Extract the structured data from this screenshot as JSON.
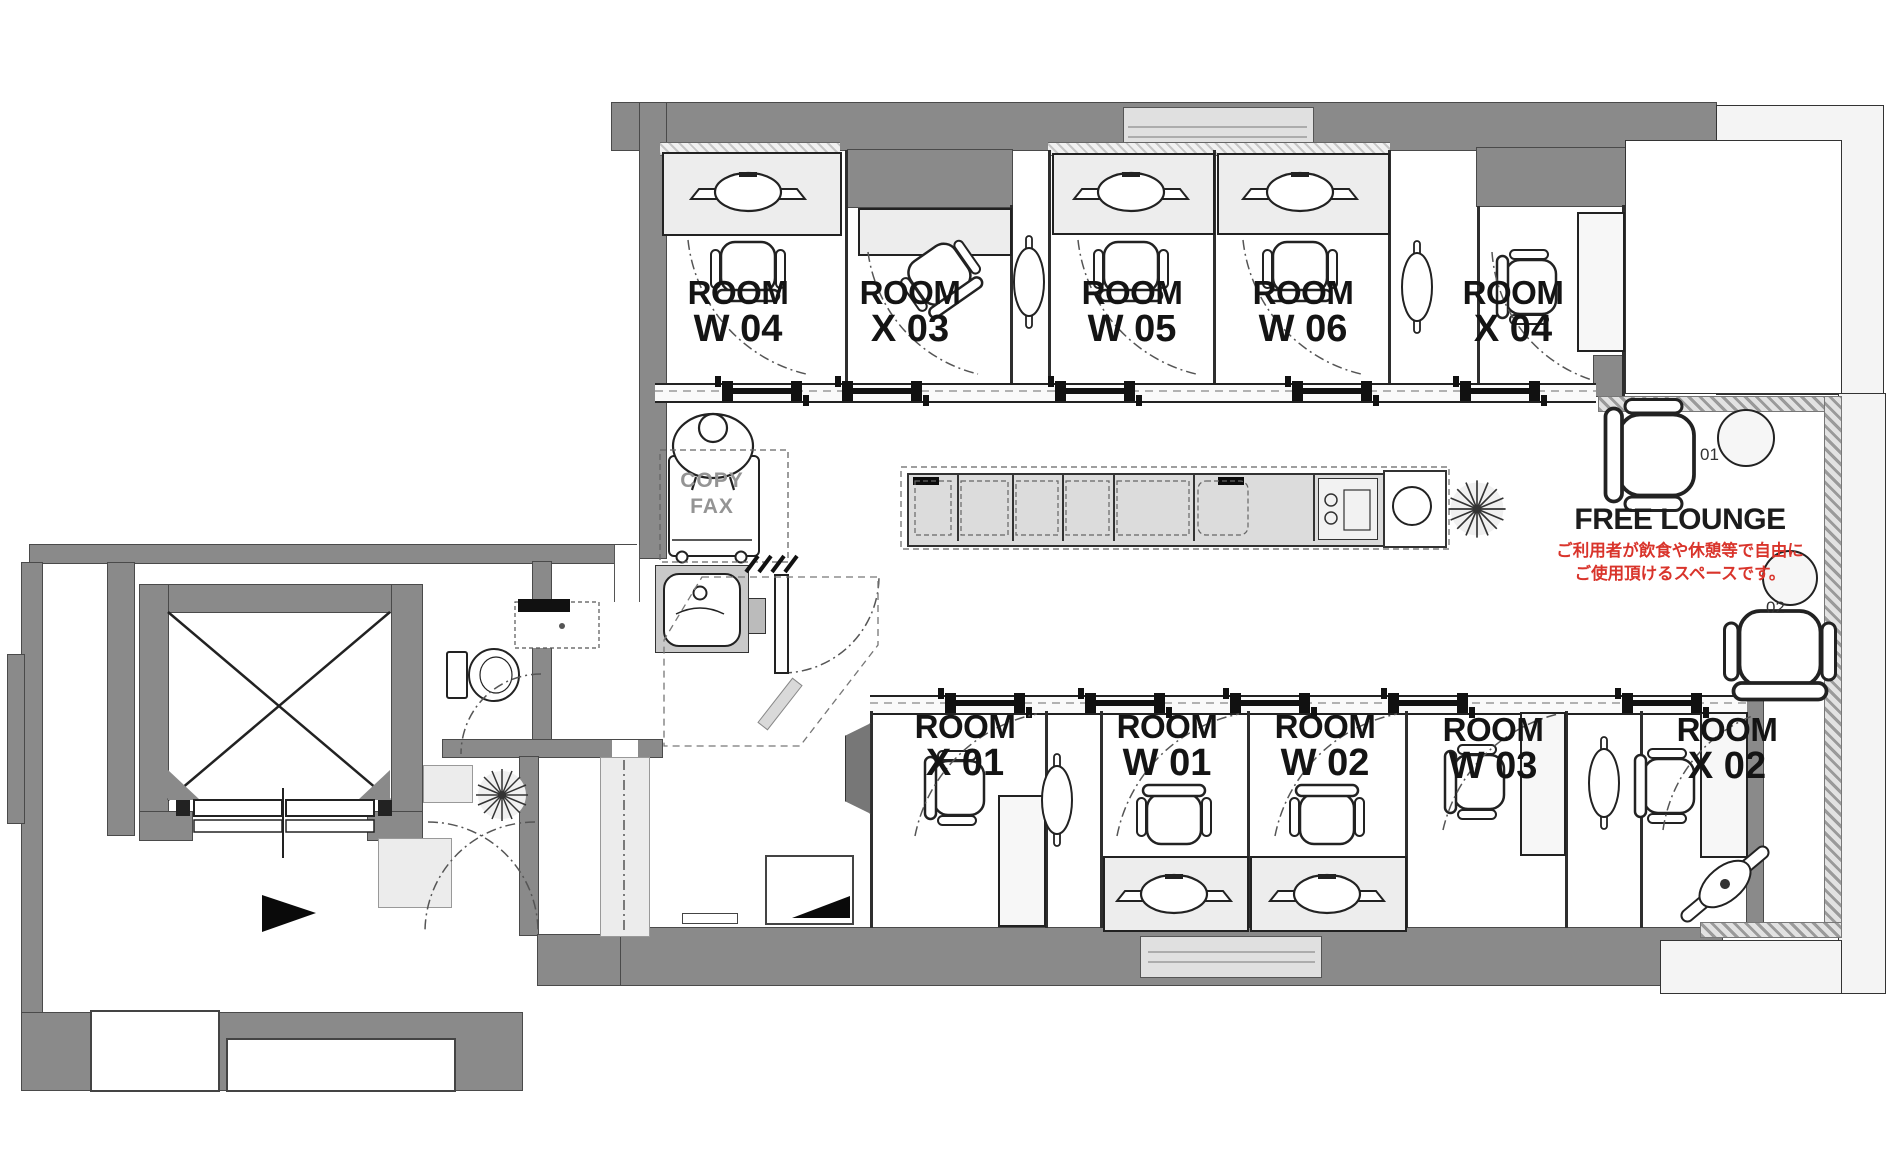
{
  "plan": {
    "rooms_top": [
      {
        "line1": "ROOM",
        "line2": "W 04"
      },
      {
        "line1": "ROOM",
        "line2": "X 03"
      },
      {
        "line1": "ROOM",
        "line2": "W 05"
      },
      {
        "line1": "ROOM",
        "line2": "W 06"
      },
      {
        "line1": "ROOM",
        "line2": "X 04"
      }
    ],
    "rooms_bottom": [
      {
        "line1": "ROOM",
        "line2": "X 01"
      },
      {
        "line1": "ROOM",
        "line2": "W 01"
      },
      {
        "line1": "ROOM",
        "line2": "W 02"
      },
      {
        "line1": "ROOM",
        "line2": "W 03"
      },
      {
        "line1": "ROOM",
        "line2": "X 02"
      }
    ],
    "lounge": {
      "title": "FREE LOUNGE",
      "note1": "ご利用者が飲食や休憩等で自由に",
      "note2": "ご使用頂けるスペースです。",
      "seat1": "01",
      "seat2": "02"
    },
    "copier": {
      "line1": "COPY",
      "line2": "FAX"
    },
    "colors": {
      "wall": "#8a8a8a",
      "floor": "#ffffff",
      "light_fill": "#ededed",
      "hatch": "#bfbfbf",
      "red": "#d9342b",
      "line": "#222222"
    }
  }
}
